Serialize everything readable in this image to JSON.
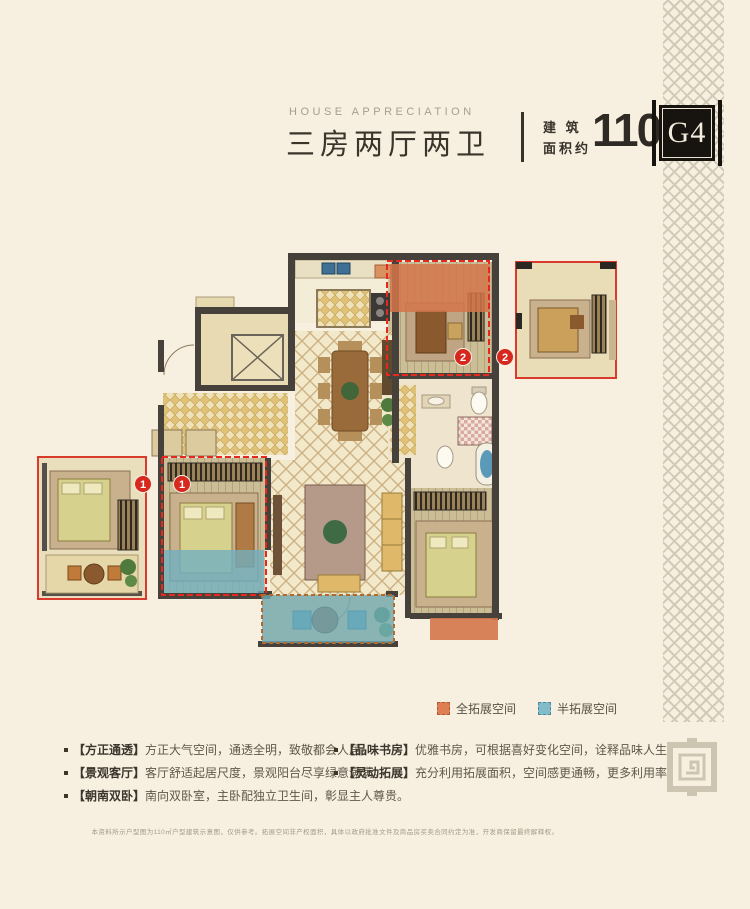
{
  "header": {
    "eyebrow": "HOUSE APPRECIATION",
    "title": "三房两厅两卫",
    "area_label": "建 筑\n面积约",
    "area_value": "110M",
    "area_unit_sup": "2",
    "unit_code": "G4"
  },
  "floorplan": {
    "badge_one": "1",
    "badge_two": "2"
  },
  "legend": {
    "full_label": "全拓展空间",
    "half_label": "半拓展空间",
    "full_color": "#dd7f53",
    "half_color": "#82bccb"
  },
  "features": {
    "left": [
      {
        "tag": "【方正通透】",
        "desc": "方正大气空间，通透全明，致敬都会人居。"
      },
      {
        "tag": "【景观客厅】",
        "desc": "客厅舒适起居尺度，景观阳台尽享绿意满满。"
      },
      {
        "tag": "【朝南双卧】",
        "desc": "南向双卧室，主卧配独立卫生间，彰显主人尊贵。"
      }
    ],
    "right": [
      {
        "tag": "【品味书房】",
        "desc": "优雅书房，可根据喜好变化空间，诠释品味人生。"
      },
      {
        "tag": "【灵动拓展】",
        "desc": "充分利用拓展面积，空间感更通畅，更多利用率。"
      }
    ]
  },
  "disclaimer": "本资料所示户型图为110㎡户型建筑示意图，仅供参考。拓展空间非产权面积，具体以政府批准文件及商品房买卖合同约定为准，开发商保留最终解释权。",
  "colors": {
    "background": "#f7f0e1",
    "ink": "#38322a",
    "red": "#d6281e",
    "orange_overlay": "#d4764a",
    "blue_overlay": "#6fb0c2",
    "wall": "#46413b",
    "pattern": "#ccc4b1"
  }
}
